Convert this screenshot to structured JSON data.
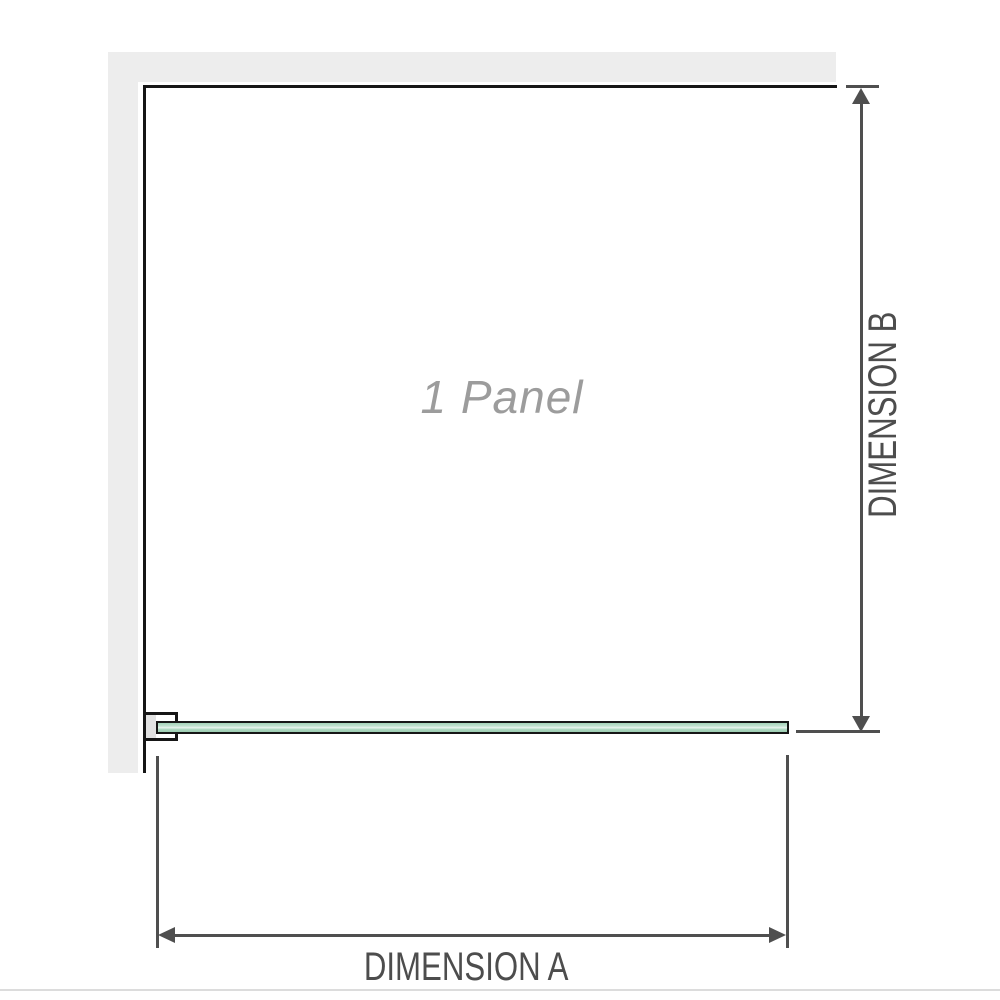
{
  "diagram": {
    "panel_label": "1 Panel",
    "dimension_a": {
      "label": "DIMENSION A"
    },
    "dimension_b": {
      "label": "DIMENSION B"
    }
  },
  "colors": {
    "wall_fill": "#ededed",
    "panel_outline": "#161616",
    "glass_green_light": "#e9f4ee",
    "glass_green_mid": "#c3e2d1",
    "glass_green_dark": "#9ccdb2",
    "dimension_line": "#4f4f4f",
    "dimension_text": "#4d4d4d",
    "panel_label_text": "#9c9c9c",
    "separator_line": "#dcdcdc"
  }
}
